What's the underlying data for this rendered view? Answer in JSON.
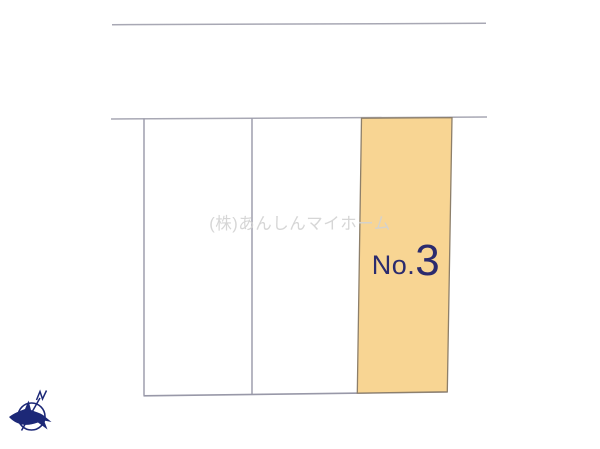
{
  "canvas": {
    "width": 600,
    "height": 449,
    "background_color": "#ffffff"
  },
  "watermark": {
    "text": "(株)あんしんマイホーム",
    "color": "#d2d2d2"
  },
  "site_plan": {
    "road_edge_color": "#a8a8b4",
    "plot_divider_color": "#9898a8",
    "plots": [
      {
        "name": "plot-1",
        "fill": "#ffffff"
      },
      {
        "name": "plot-2",
        "fill": "#ffffff"
      },
      {
        "name": "plot-3",
        "fill": "#f8d593",
        "border_color": "#8d7f6a",
        "label_prefix": "No.",
        "label_number": "3",
        "label_color": "#2b2b6e"
      }
    ]
  },
  "compass": {
    "icon": "north-compass-bird-icon",
    "color": "#1c2877",
    "direction_label": "N"
  }
}
